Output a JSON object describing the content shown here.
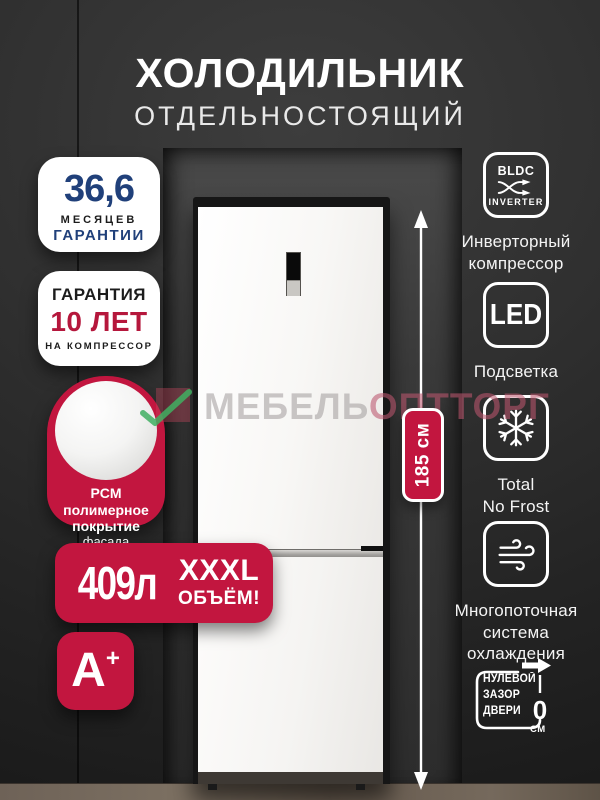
{
  "header": {
    "title": "ХОЛОДИЛЬНИК",
    "subtitle": "ОТДЕЛЬНОСТОЯЩИЙ"
  },
  "left_badges": {
    "months": {
      "value": "36,6",
      "unit": "МЕСЯЦЕВ",
      "label": "ГАРАНТИИ"
    },
    "compressor": {
      "title": "ГАРАНТИЯ",
      "value": "10 ЛЕТ",
      "subtitle": "НА КОМПРЕССОР"
    },
    "coating": {
      "line1": "PCM полимерное",
      "line2": "покрытие",
      "line3": "фасада"
    },
    "volume": {
      "value": "409л",
      "highlight": "XXXL",
      "label": "ОБЪЁМ!"
    },
    "energy": {
      "letter": "A",
      "plus": "+"
    }
  },
  "measurement": {
    "height": "185 см"
  },
  "features": [
    {
      "name": "inverter-compressor",
      "box_top": "BLDC",
      "box_bottom": "INVERTER",
      "label": "Инверторный\nкомпрессор"
    },
    {
      "name": "led-light",
      "box_text": "LED",
      "label": "Подсветка"
    },
    {
      "name": "total-no-frost",
      "label": "Total\nNo Frost"
    },
    {
      "name": "multi-flow-cooling",
      "label": "Многопоточная\nсистема\nохлаждения"
    },
    {
      "name": "zero-door-gap",
      "lines": "НУЛЕВОЙ\nЗАЗОР\nДВЕРИ",
      "value": "0",
      "unit": "см"
    }
  ],
  "watermark": {
    "brand_gray": "МЕБЕЛЬ",
    "brand_red": "ОПТТОРГ"
  },
  "colors": {
    "crimson": "#c2163f",
    "navy": "#20407a",
    "text_red": "#b5173c",
    "background_dark": "#2e2e2e"
  }
}
